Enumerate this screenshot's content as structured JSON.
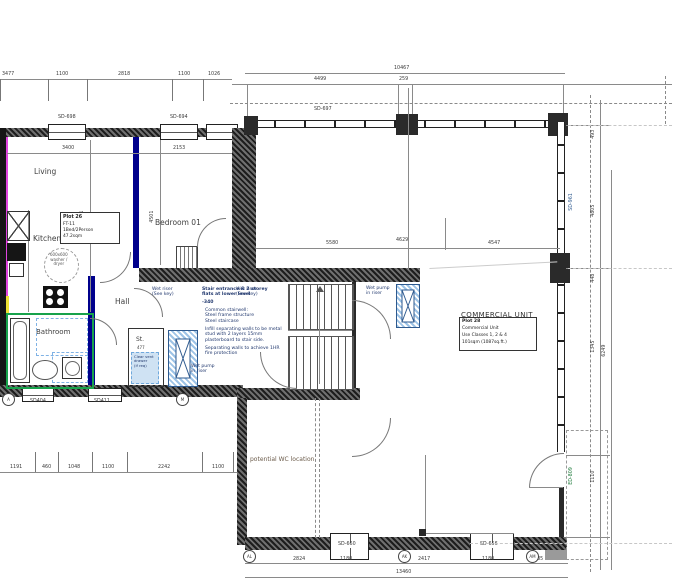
{
  "plan": {
    "rooms": {
      "living": "Living",
      "kitchen": "Kitchen",
      "bathroom": "Bathroom",
      "hall": "Hall",
      "store": "St.",
      "store_dim": "477",
      "bedroom": "Bedroom 01",
      "commercial": "COMMERCIAL UNIT",
      "wc_note": "potential WC location"
    },
    "plot_box": {
      "plot": "Plot 26",
      "type": "FT-11",
      "beds": "1Bed/2Person",
      "area": "47.2sqm"
    },
    "commercial_box": {
      "plot": "Plot 28",
      "use": "Commercial Unit",
      "classes": "Use Classes 1, 2 & 4",
      "area": "101sqm (1087sq.ft.)"
    },
    "stair_note": {
      "title": "Stair entrance & 2 storey\nflats at lower level",
      "level": "-340",
      "body1": "Common stairwell:\nSteel frame structure\nSteel staircase",
      "body2": "Infill separating walls to be metal\nstud with 2 layers 15mm\nplasterboard to stair side.",
      "body3": "Separating walls to achieve 1HR\nfire protection"
    },
    "notes": {
      "wet_pump": "Wet pump\nin riser",
      "wet_riser": "Wet riser\n(See key)",
      "washer": "600x600\nwasher /\ndryer",
      "store_note": "Clear vent\ndrawer\n(if req)"
    },
    "windows": {
      "t1": "SD-698",
      "t2": "SD-694",
      "t3": "SD-697",
      "b1": "SD404",
      "b2": "SD411",
      "b3": "SD-660",
      "b4": "SD-656",
      "door": "ED-809",
      "right": "SD-961"
    },
    "bubbles": {
      "a": "A",
      "m": "M",
      "al": "AL",
      "ak": "AK",
      "am": "AM"
    },
    "dims": {
      "tl1": "3477",
      "tl2": "1100",
      "tl3": "2818",
      "tl4": "1100",
      "tl5": "1026",
      "tr_total": "10467",
      "tr1": "4499",
      "tr2": "259",
      "i1": "3400",
      "i2": "2153",
      "i3": "4501",
      "i4": "4501",
      "m1": "5580",
      "m2": "4629",
      "m3": "4547",
      "bl1": "1191",
      "bl2": "460",
      "bl3": "1048",
      "bl4": "1100",
      "bl5": "2242",
      "bl6": "1100",
      "b1": "2824",
      "b2": "1180",
      "b3": "2417",
      "b4": "1180",
      "b5": "1885",
      "b_total": "13460",
      "r1": "493",
      "r2": "4805",
      "r3": "448",
      "r4": "1345",
      "r5": "1110",
      "r6": "6249"
    }
  }
}
